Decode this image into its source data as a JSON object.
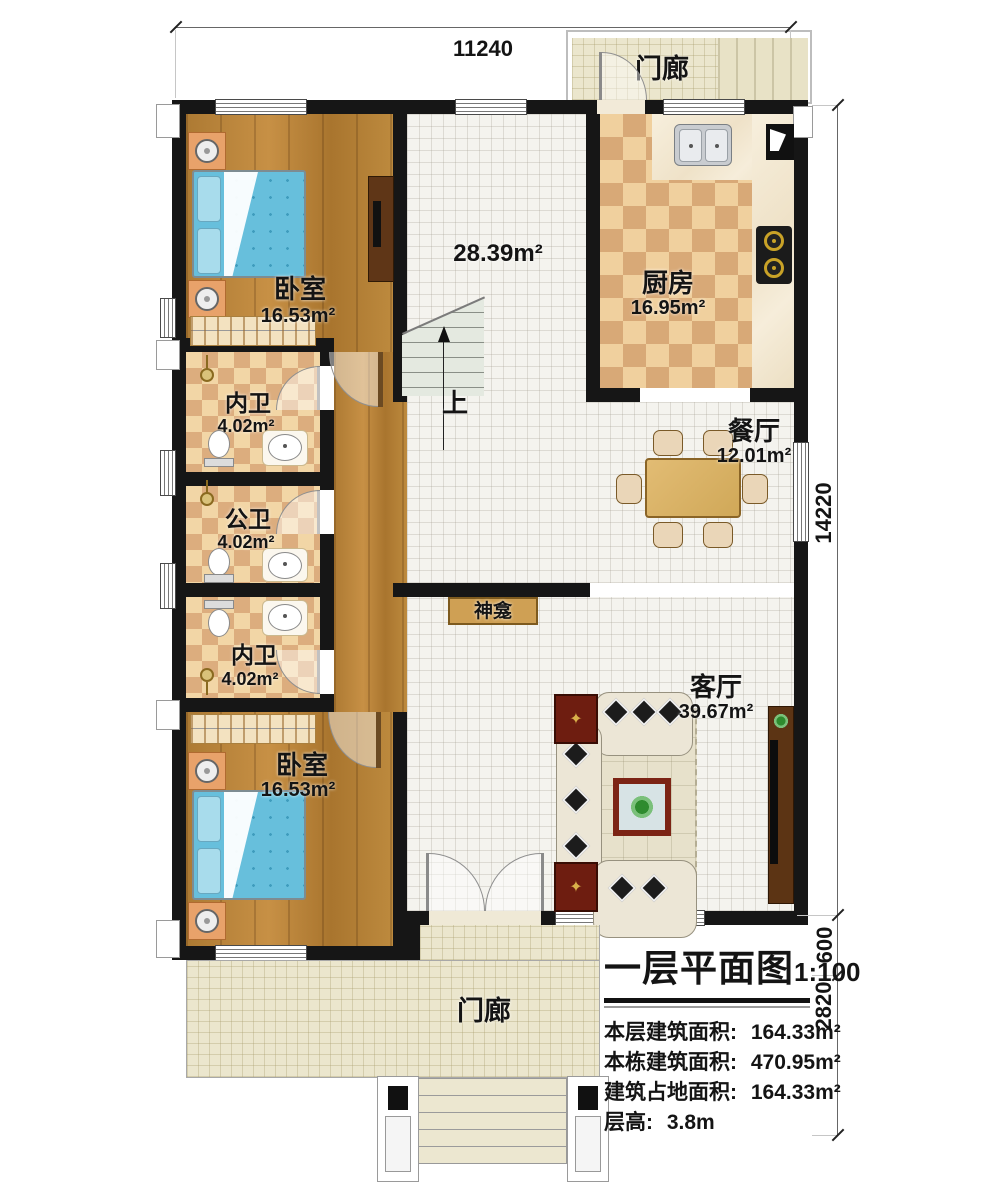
{
  "plan": {
    "dimensions": {
      "top": "11240",
      "side_main": "14220",
      "side_mid": "600",
      "side_bottom": "2820"
    },
    "rooms": {
      "porch_top": {
        "name": "门廊"
      },
      "kitchen": {
        "name": "厨房",
        "area": "16.95m²"
      },
      "bedroom_top": {
        "name": "卧室",
        "area": "16.53m²"
      },
      "hall": {
        "area": "28.39m²",
        "up": "上"
      },
      "bath_top": {
        "name": "内卫",
        "area": "4.02m²"
      },
      "bath_mid": {
        "name": "公卫",
        "area": "4.02m²"
      },
      "bath_bottom": {
        "name": "内卫",
        "area": "4.02m²"
      },
      "dining": {
        "name": "餐厅",
        "area": "12.01m²"
      },
      "shrine": {
        "name": "神龛"
      },
      "living": {
        "name": "客厅",
        "area": "39.67m²"
      },
      "bedroom_bottom": {
        "name": "卧室",
        "area": "16.53m²"
      },
      "porch_bottom": {
        "name": "门廊"
      }
    },
    "title_block": {
      "title": "一层平面图",
      "scale": "1:100",
      "rows": [
        {
          "label": "本层建筑面积:",
          "value": "164.33m²"
        },
        {
          "label": "本栋建筑面积:",
          "value": "470.95m²"
        },
        {
          "label": "建筑占地面积:",
          "value": "164.33m²"
        },
        {
          "label": "层高:",
          "value": "3.8m"
        }
      ]
    }
  }
}
